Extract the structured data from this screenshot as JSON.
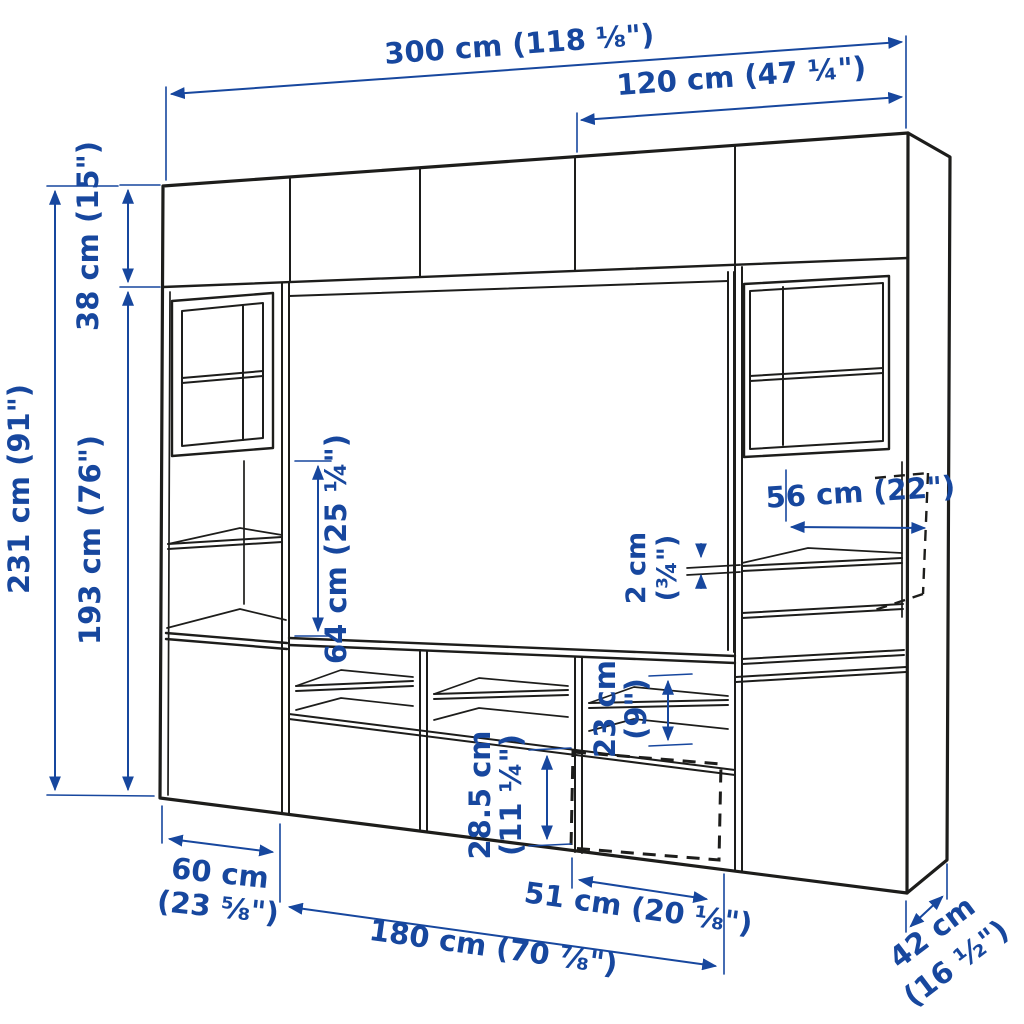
{
  "page": {
    "background": "#ffffff"
  },
  "diagram": {
    "description": "Wall storage / TV bench combination line drawing with dimensions",
    "accent_color": "#17479e",
    "line_color": "#1d1d1b",
    "labels": {
      "total_width": "300 cm (118 ⅛\")",
      "right_section_width": "120 cm (47 ¼\")",
      "top_cabinet_height": "38 cm (15\")",
      "total_height": "231 cm (91\")",
      "lower_section_height": "193 cm (76\")",
      "tv_opening_height": "64 cm (25 ¼\")",
      "shelf_width": "56 cm (22\")",
      "shelf_thickness_cm": "2 cm",
      "shelf_thickness_in": "(¾\")",
      "open_compartment_height_cm": "23 cm",
      "open_compartment_height_in": "(9\")",
      "drawer_front_height_cm": "28.5 cm",
      "drawer_front_height_in": "(11 ¼\")",
      "left_cabinet_width_cm": "60 cm",
      "left_cabinet_width_in": "(23 ⅝\")",
      "drawer_width": "51 cm (20 ⅛\")",
      "tv_bench_width": "180 cm (70 ⅞\")",
      "depth_cm": "42 cm",
      "depth_in": "(16 ½\")"
    }
  }
}
